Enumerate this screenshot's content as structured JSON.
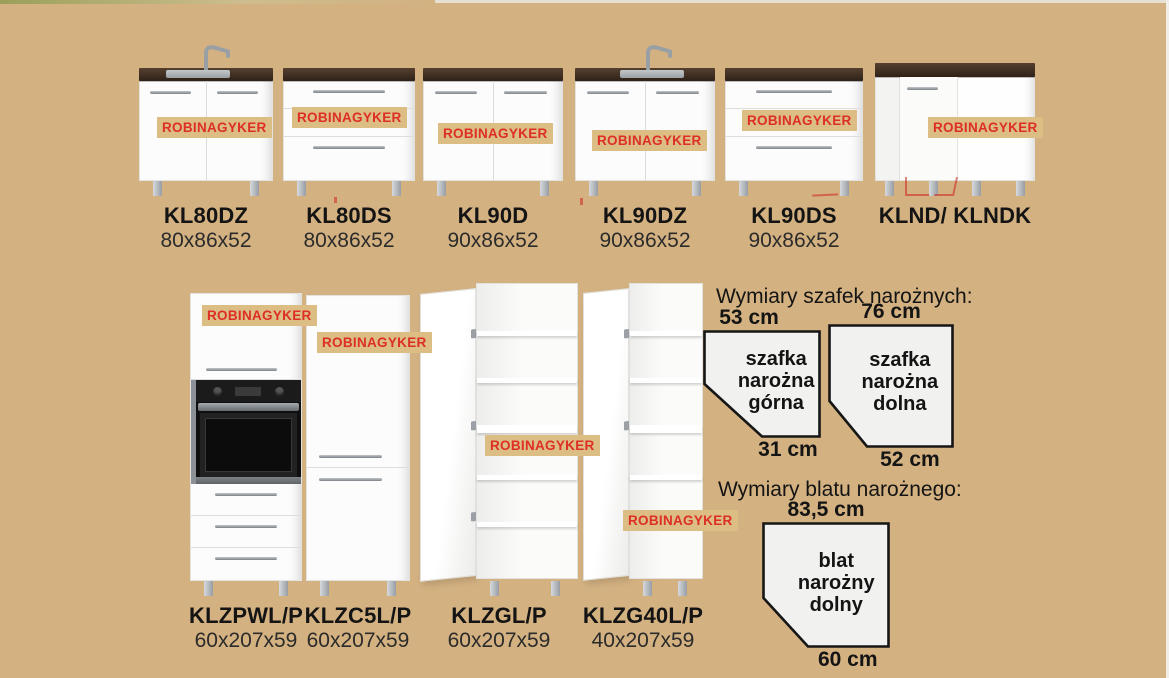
{
  "watermark": "ROBINAGYKER",
  "colors": {
    "page_bg": "#d3b181",
    "watermark_bg": "#dcbd84",
    "watermark_text": "#dd2e27",
    "countertop": "#33241b",
    "cabinet_white": "#fcfcfc",
    "diagram_fill": "#f1f1ef",
    "diagram_stroke": "#161616"
  },
  "top_row": [
    {
      "name": "KL80DZ",
      "dims": "80x86x52"
    },
    {
      "name": "KL80DS",
      "dims": "80x86x52"
    },
    {
      "name": "KL90D",
      "dims": "90x86x52"
    },
    {
      "name": "KL90DZ",
      "dims": "90x86x52"
    },
    {
      "name": "KL90DS",
      "dims": "90x86x52"
    },
    {
      "name": "KLND/ KLNDK",
      "dims": ""
    }
  ],
  "bottom_row": [
    {
      "name": "KLZPWL/P",
      "dims": "60x207x59"
    },
    {
      "name": "KLZC5L/P",
      "dims": "60x207x59"
    },
    {
      "name": "KLZGL/P",
      "dims": "60x207x59"
    },
    {
      "name": "KLZG40L/P",
      "dims": "40x207x59"
    }
  ],
  "corner_cabinets": {
    "title": "Wymiary szafek narożnych:",
    "upper": {
      "top_width": "53 cm",
      "label": "szafka narożna górna",
      "bottom_width": "31 cm"
    },
    "lower": {
      "top_width": "76 cm",
      "label": "szafka narożna dolna",
      "bottom_width": "52 cm"
    }
  },
  "corner_worktop": {
    "title": "Wymiary blatu narożnego:",
    "shape": {
      "top_width": "83,5 cm",
      "label": "blat narożny dolny",
      "bottom_width": "60 cm"
    }
  }
}
